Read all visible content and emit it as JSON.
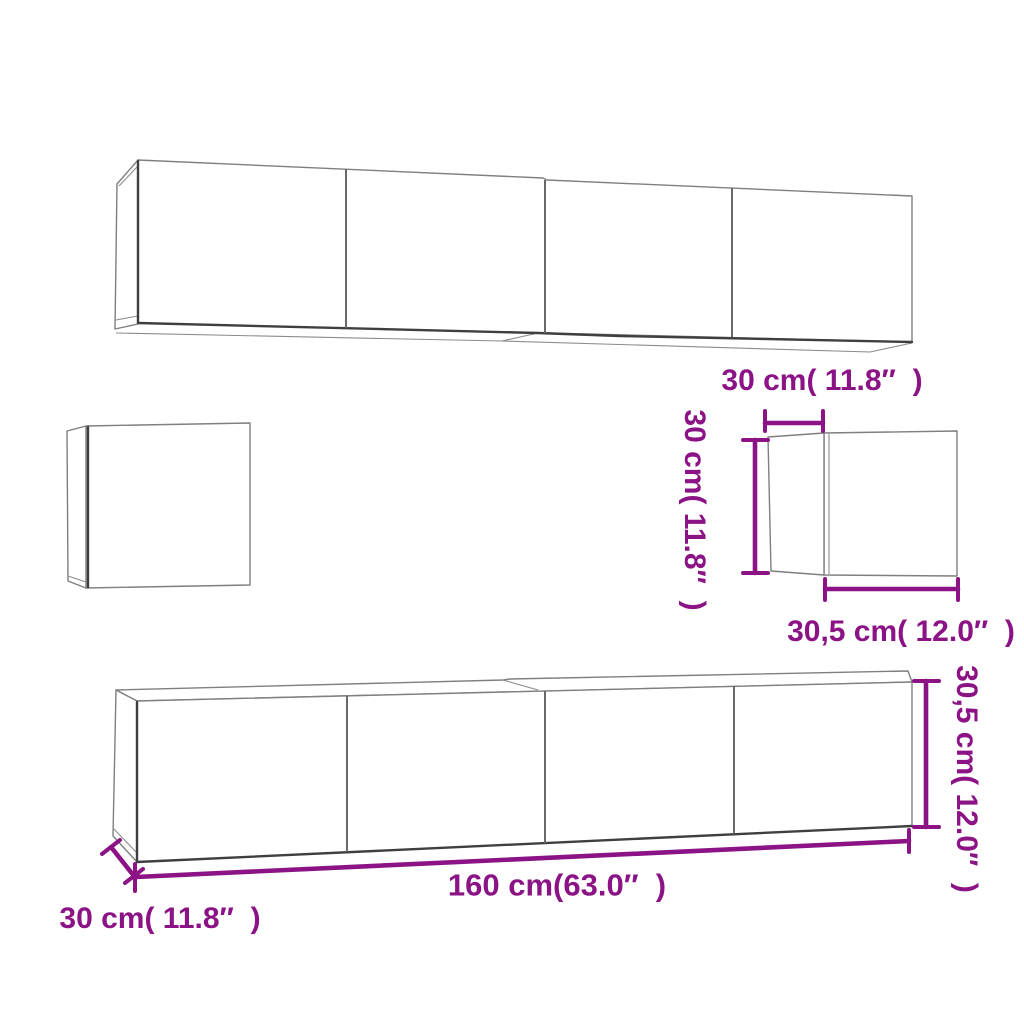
{
  "colors": {
    "dimension_accent": "#8b1385",
    "outline": "#7f7f7f",
    "outline_dark": "#3f3f3f",
    "background": "#ffffff"
  },
  "labels": {
    "small_cabinet_depth_top": "30 cm( 11.8″  )",
    "small_cabinet_height_side": "30 cm( 11.8″  )",
    "small_cabinet_width_bottom": "30,5 cm( 12.0″  )",
    "tv_bench_length": "160 cm(63.0″  )",
    "tv_bench_depth": "30 cm( 11.8″  )",
    "tv_bench_height": "30,5 cm( 12.0″  )"
  }
}
